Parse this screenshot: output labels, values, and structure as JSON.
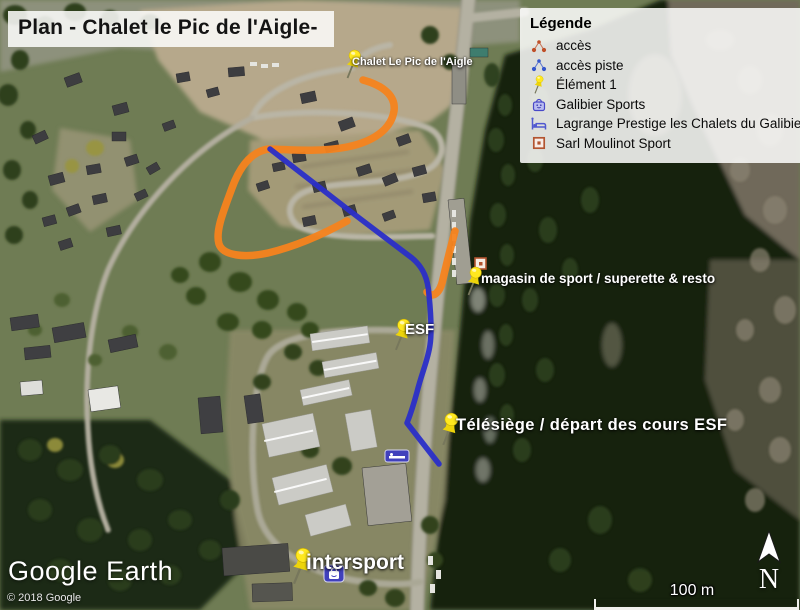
{
  "title": "Plan - Chalet le Pic de l'Aigle-",
  "legend": {
    "heading": "Légende",
    "items": [
      {
        "icon": "route-dots-red-icon",
        "label": "accès"
      },
      {
        "icon": "route-dots-blue-icon",
        "label": "accès piste"
      },
      {
        "icon": "pushpin-icon",
        "label": "Élément 1"
      },
      {
        "icon": "shopping-bag-icon",
        "label": "Galibier Sports"
      },
      {
        "icon": "bed-icon",
        "label": "Lagrange Prestige les Chalets du Galibier"
      },
      {
        "icon": "square-marker-icon",
        "label": "Sarl Moulinot Sport"
      }
    ]
  },
  "map": {
    "pins": [
      {
        "label": "Chalet Le Pic de l'Aigle"
      },
      {
        "label": "magasin de sport / superette & resto"
      },
      {
        "label": "ESF"
      },
      {
        "label": "Télésiège / départ des cours ESF"
      },
      {
        "label": "intersport"
      }
    ]
  },
  "attribution": {
    "logo": "Google Earth",
    "copyright": "© 2018 Google"
  },
  "scale": {
    "label": "100 m"
  },
  "compass": {
    "label": "N"
  },
  "colors": {
    "path-orange": "#f5831e",
    "path-blue": "#2a2ec8",
    "pin-yellow": "#ffe81f",
    "access-red": "#bf4f28",
    "piste-blue": "#3556cc",
    "sign-blue": "#4040bc",
    "moulinot-red": "#b35430"
  }
}
